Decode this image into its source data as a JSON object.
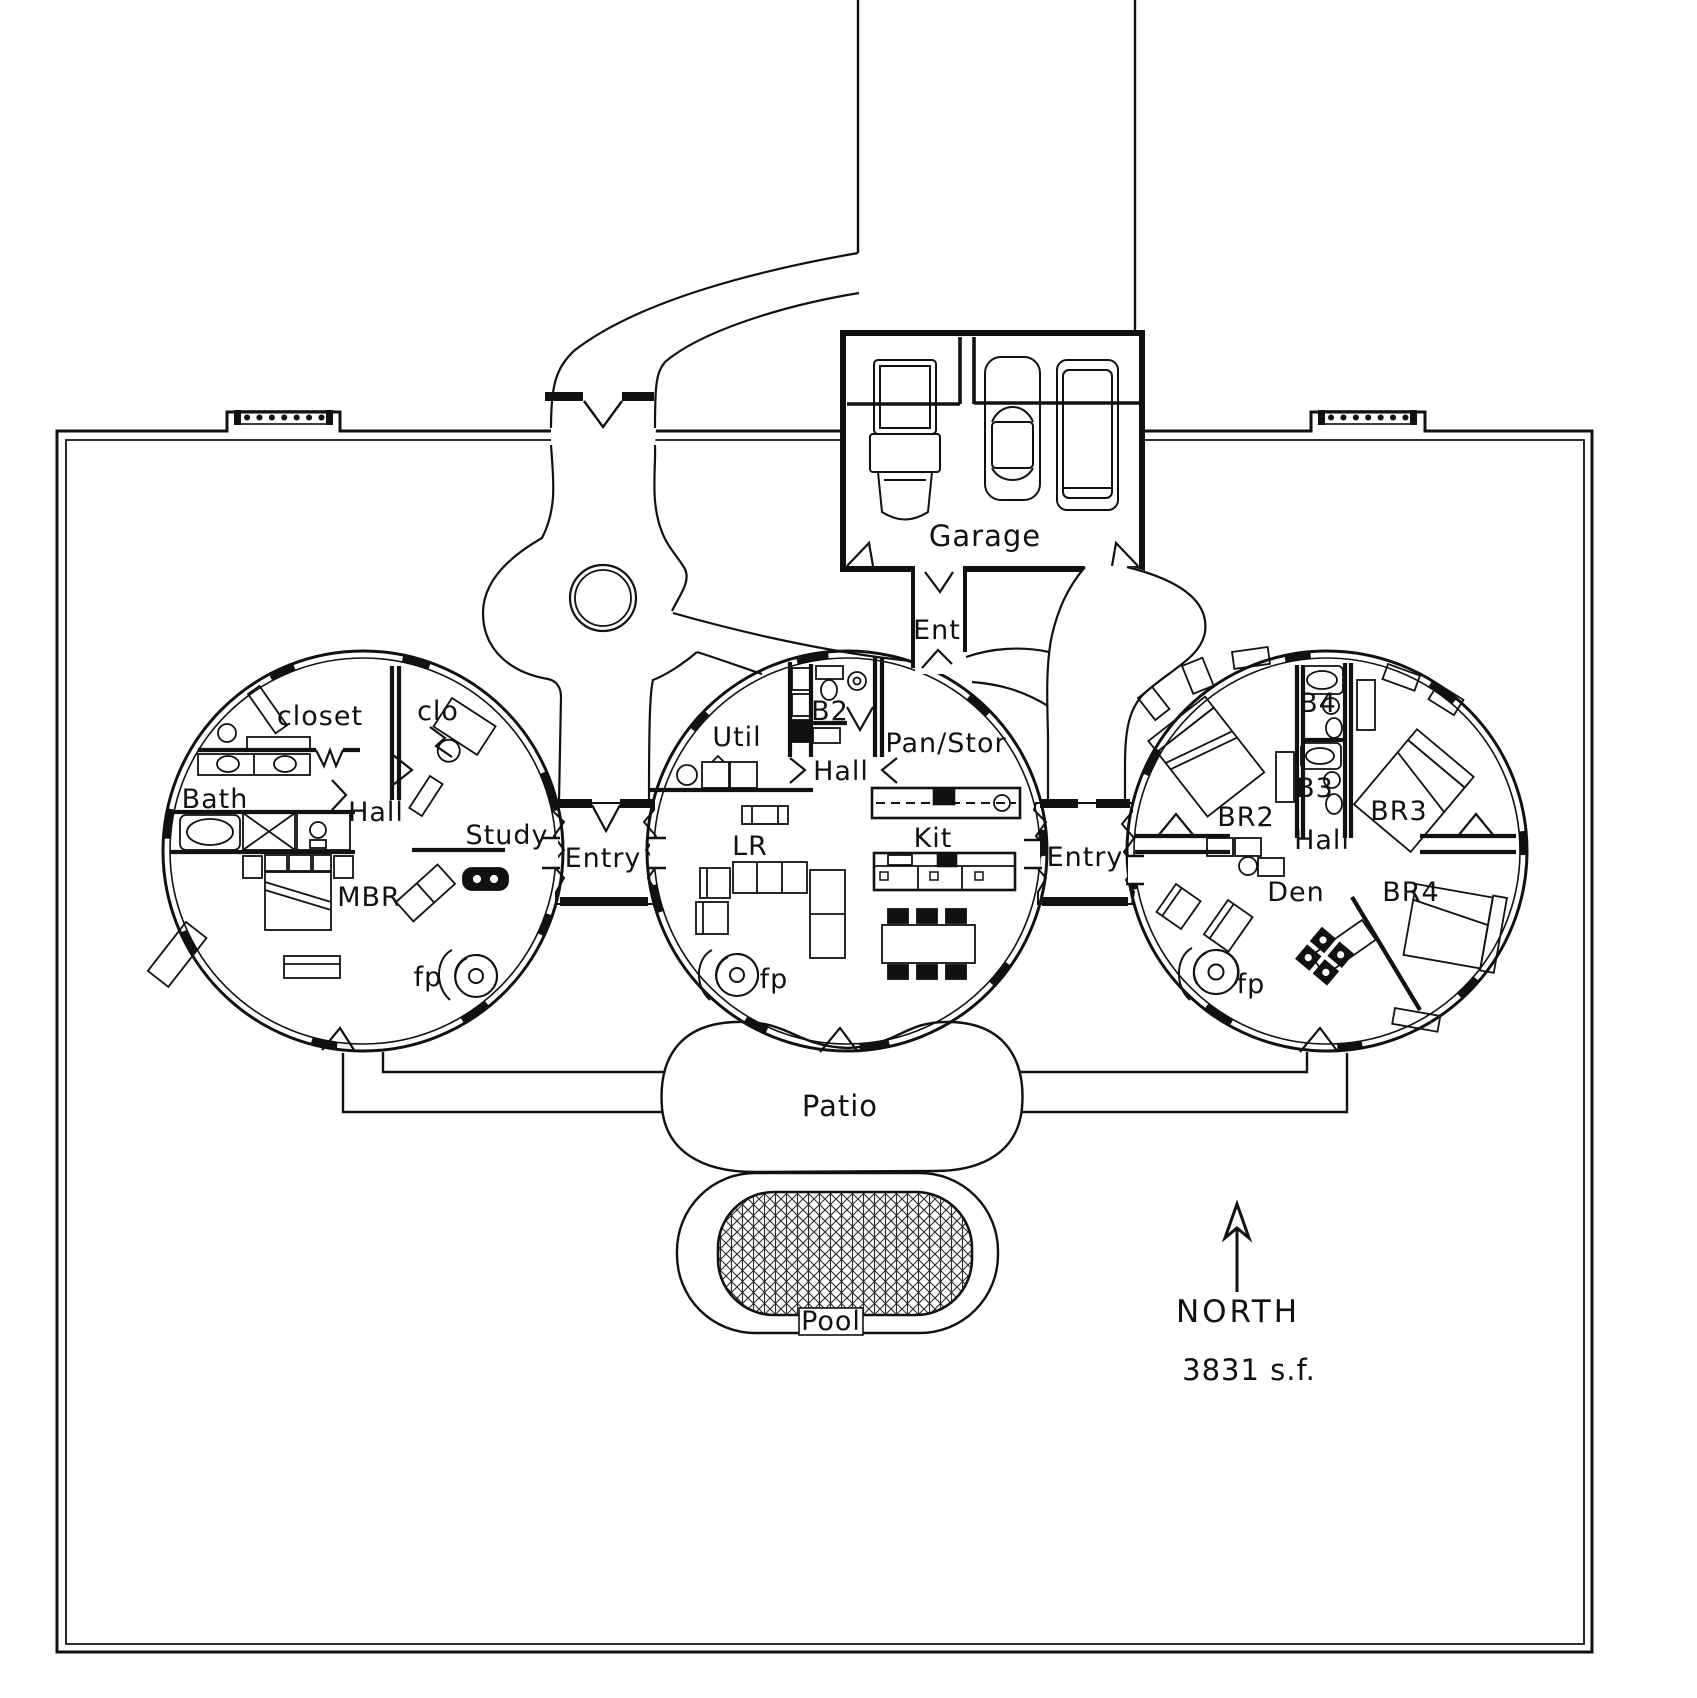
{
  "plan_title": "Dome home floor plan",
  "annotations": {
    "north": "NORTH",
    "area": "3831  s.f."
  },
  "site": {
    "garage": "Garage",
    "ent_corridor": "Ent",
    "patio": "Patio",
    "pool": "Pool"
  },
  "entries": {
    "west": "Entry",
    "east": "Entry"
  },
  "pod_master": {
    "closet": "closet",
    "clo": "clo",
    "bath": "Bath",
    "hall": "Hall",
    "study": "Study",
    "mbr": "MBR",
    "fp": "fp"
  },
  "pod_living": {
    "util": "Util",
    "b2": "B2",
    "hall": "Hall",
    "pan_stor": "Pan/Stor",
    "lr": "LR",
    "kit": "Kit",
    "fp": "fp"
  },
  "pod_bedrooms": {
    "b4": "B4",
    "b3": "B3",
    "br2": "BR2",
    "br3": "BR3",
    "hall": "Hall",
    "den": "Den",
    "br4": "BR4",
    "fp": "fp"
  },
  "colors": {
    "line": "#111111",
    "background": "#ffffff"
  }
}
